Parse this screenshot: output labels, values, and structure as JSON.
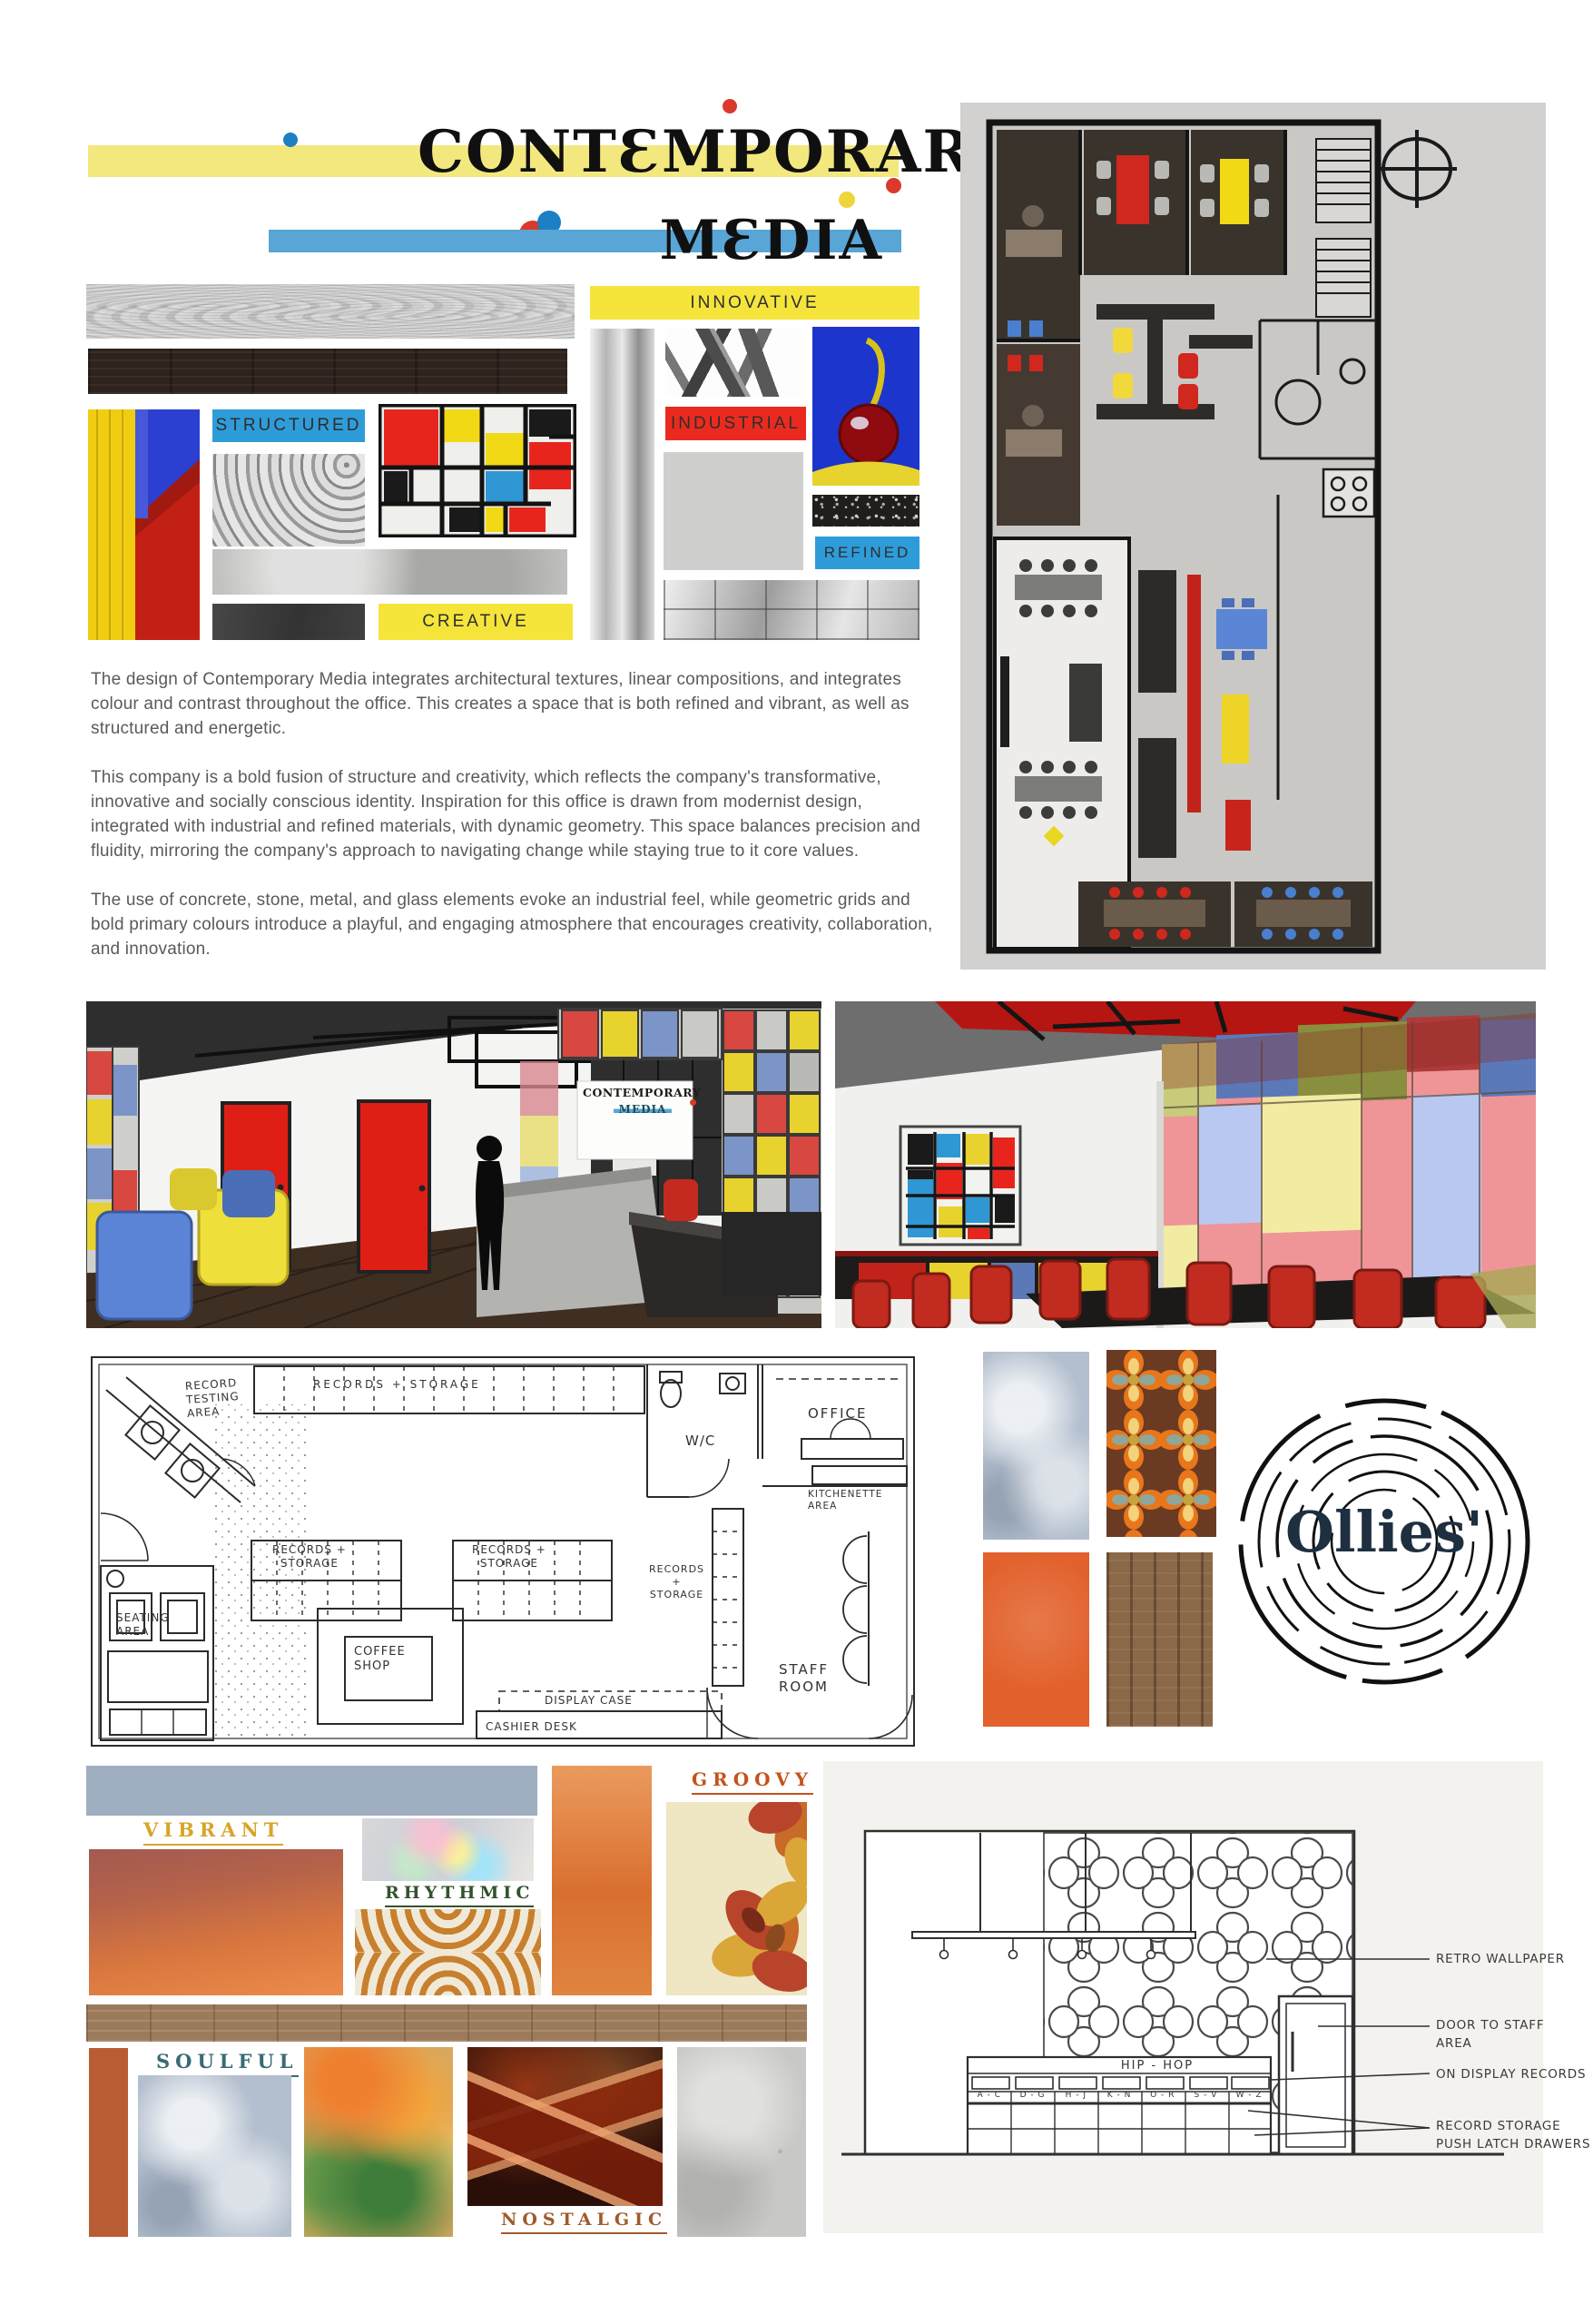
{
  "palette": {
    "primary_yellow": "#F2DF3A",
    "primary_blue": "#2F97D4",
    "primary_red": "#E8251D",
    "title_bar_yellow": "#F3E87E",
    "title_bar_blue": "#58A5D6",
    "plan_background": "#D2D1CF",
    "elevation_background": "#F3F2EF"
  },
  "header": {
    "title_line1": "CONTƐMPORARY",
    "title_line2": "MƐDIA"
  },
  "office_moodboard": {
    "innovative": "INNOVATIVE",
    "structured": "STRUCTURED",
    "industrial": "INDUSTRIAL",
    "refined": "REFINED",
    "creative": "CREATIVE"
  },
  "body": {
    "p1": "The design of Contemporary Media integrates architectural textures, linear compositions, and integrates colour and contrast throughout the office. This creates a space that is both refined and vibrant, as well as structured and energetic.",
    "p2": "This company is a bold fusion of structure and creativity, which reflects the company's transformative, innovative and socially conscious identity. Inspiration for this office is drawn from modernist design, integrated with industrial and refined materials, with dynamic geometry. This space balances precision and fluidity, mirroring the company's approach to navigating change while staying true to it core values.",
    "p3": "The use of concrete, stone, metal, and glass elements evoke an industrial feel, while geometric grids and bold primary colours introduce a playful, and engaging atmosphere that encourages creativity, collaboration, and innovation."
  },
  "office_render_sign": {
    "line1": "CONTEMPORARY",
    "line2": "MEDIA"
  },
  "record_plan": {
    "record_testing": "RECORD\nTESTING\nAREA",
    "top_shelf": "RECORDS + STORAGE",
    "island_left": "RECORDS +\nSTORAGE",
    "island_right": "RECORDS +\nSTORAGE",
    "seating": "SEATING\nAREA",
    "coffee_shop": "COFFEE\nSHOP",
    "display_case": "DISPLAY CASE",
    "cashier_desk": "CASHIER DESK",
    "wc": "W/C",
    "office": "OFFICE",
    "kitchenette": "KITCHENETTE\nAREA",
    "records_vertical": "RECORDS\n+\nSTORAGE",
    "staff_room": "STAFF\nROOM"
  },
  "ollies": {
    "logo_text": "Ollies'"
  },
  "record_moodboard": {
    "vibrant": "VIBRANT",
    "rhythmic": "RHYTHMIC",
    "groovy": "GROOVY",
    "soulful": "SOULFUL",
    "nostalgic": "NOSTALGIC"
  },
  "elevation": {
    "cabinet_title": "HIP - HOP",
    "drawers": [
      "A - C",
      "D - G",
      "H - J",
      "K - N",
      "O - R",
      "S - V",
      "W - Z"
    ],
    "annotations": {
      "wallpaper": "RETRO WALLPAPER",
      "door": "DOOR TO STAFF\nAREA",
      "display": "ON DISPLAY RECORDS",
      "storage": "RECORD STORAGE\nPUSH LATCH DRAWERS"
    }
  }
}
